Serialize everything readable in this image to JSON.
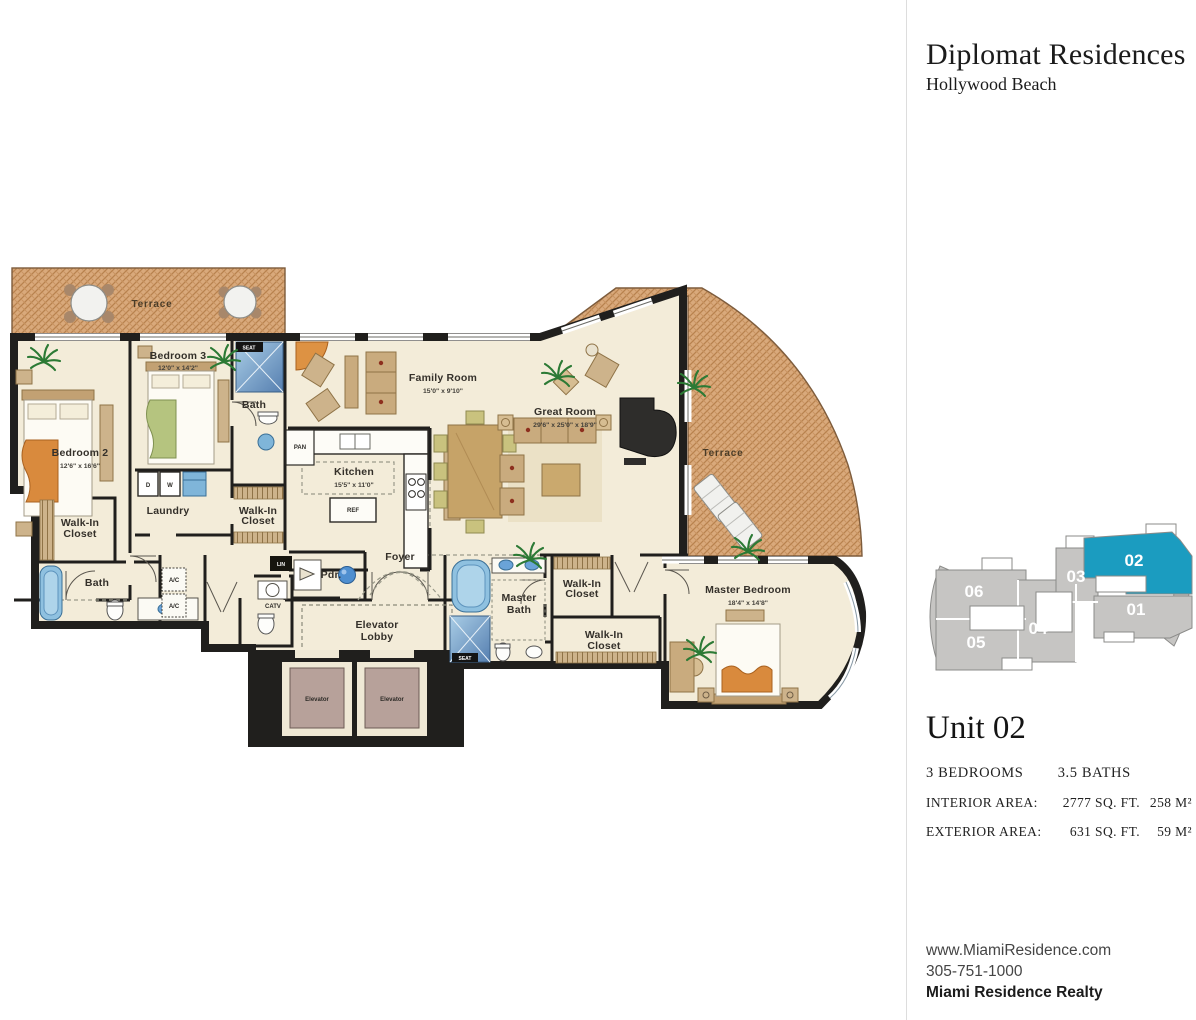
{
  "brand": {
    "title": "Diplomat Residences",
    "subtitle": "Hollywood Beach"
  },
  "unit": {
    "title": "Unit 02",
    "bedrooms": "3 BEDROOMS",
    "baths": "3.5 BATHS",
    "interior_label": "INTERIOR AREA:",
    "interior_sqft": "2777 SQ. FT.",
    "interior_m2": "258 M²",
    "exterior_label": "EXTERIOR AREA:",
    "exterior_sqft": "631 SQ. FT.",
    "exterior_m2": "59 M²"
  },
  "colors": {
    "accent": "#1b9cc0",
    "keyplan_gray": "#c6c5c3",
    "wall": "#201f1d",
    "floor": "#f3ecd9",
    "terrace": "#d9a97b",
    "fixture_blue": "#7fb5d9",
    "elevator_car": "#b7a19a"
  },
  "keyplan": {
    "highlighted": "02",
    "units": [
      {
        "label": "06"
      },
      {
        "label": "05"
      },
      {
        "label": "04"
      },
      {
        "label": "03"
      },
      {
        "label": "02"
      },
      {
        "label": "01"
      }
    ]
  },
  "floorplan": {
    "rooms": {
      "terrace_top": {
        "label": "Terrace"
      },
      "terrace_right": {
        "label": "Terrace"
      },
      "bedroom2": {
        "label": "Bedroom 2",
        "dims": "12'6\" x 16'6\""
      },
      "bedroom3": {
        "label": "Bedroom 3",
        "dims": "12'0\" x 14'2\""
      },
      "bath3": {
        "label": "Bath"
      },
      "laundry": {
        "label": "Laundry"
      },
      "wic_bed3": {
        "line1": "Walk-In",
        "line2": "Closet"
      },
      "wic_bed2": {
        "line1": "Walk-In",
        "line2": "Closet"
      },
      "bath2": {
        "label": "Bath"
      },
      "ac": {
        "label": "A/C"
      },
      "family": {
        "label": "Family Room",
        "dims": "15'0\" x 9'10\""
      },
      "great": {
        "label": "Great Room",
        "dims": "29'6\" x 25'0\" x 18'9\""
      },
      "kitchen": {
        "label": "Kitchen",
        "dims": "15'5\" x 11'0\""
      },
      "pan": {
        "label": "PAN"
      },
      "ref": {
        "label": "REF"
      },
      "foyer": {
        "label": "Foyer"
      },
      "pdr": {
        "label": "Pdr."
      },
      "lin": {
        "label": "LIN"
      },
      "catv": {
        "label": "CATV"
      },
      "lobby": {
        "line1": "Elevator",
        "line2": "Lobby"
      },
      "elevator": {
        "label": "Elevator"
      },
      "mbath": {
        "line1": "Master",
        "line2": "Bath"
      },
      "seat": {
        "label": "SEAT"
      },
      "wic_m1": {
        "line1": "Walk-In",
        "line2": "Closet"
      },
      "wic_m2": {
        "line1": "Walk-In",
        "line2": "Closet"
      },
      "master": {
        "label": "Master Bedroom",
        "dims": "18'4\" x 14'8\""
      },
      "appliance_d": {
        "label": "D"
      },
      "appliance_w": {
        "label": "W"
      }
    }
  },
  "footer": {
    "website": "www.MiamiResidence.com",
    "phone": "305-751-1000",
    "company": "Miami Residence Realty"
  }
}
